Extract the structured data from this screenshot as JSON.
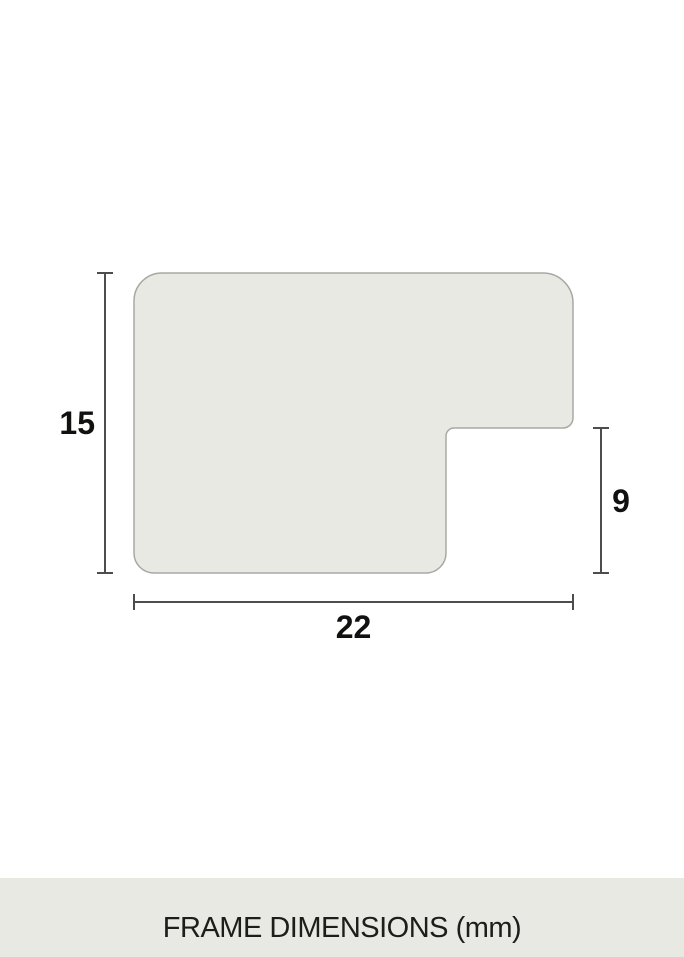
{
  "diagram": {
    "dimensions": {
      "height": "15",
      "width": "22",
      "notch_height": "9"
    },
    "caption": "FRAME DIMENSIONS (mm)",
    "colors": {
      "background": "#ffffff",
      "shape_fill": "#e9e9e4",
      "shape_stroke": "#a8a8a3",
      "dimension_line": "#4d4d4b",
      "label_text": "#111110",
      "caption_band": "#e9e9e4",
      "caption_text": "#1d1d1b"
    }
  }
}
